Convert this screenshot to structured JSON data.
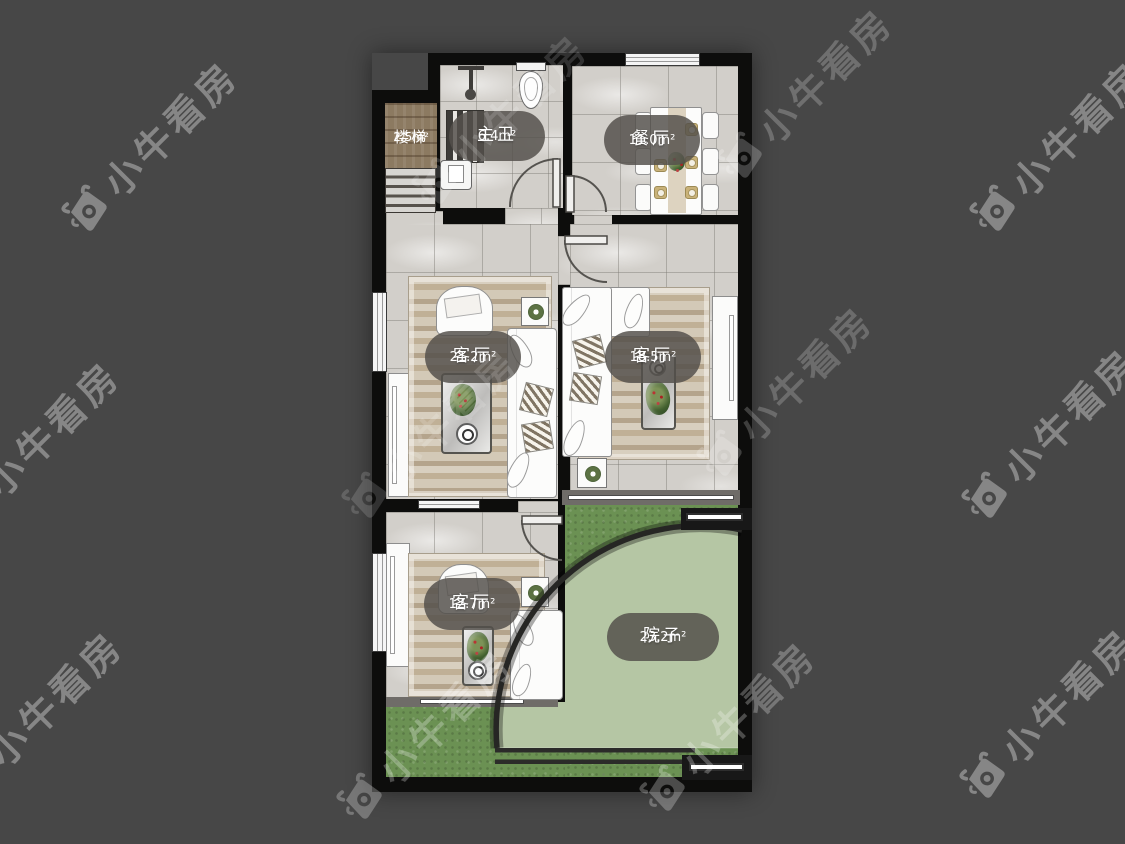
{
  "watermark": {
    "text": "小牛看房",
    "icon": "bull-camera-logo"
  },
  "rooms": {
    "stairs": {
      "name": "楼梯",
      "area": "2.5m²"
    },
    "bathroom": {
      "name": "主卫",
      "area": "6.4m²"
    },
    "dining": {
      "name": "餐厅",
      "area": "11.0m²"
    },
    "living_left": {
      "name": "客厅",
      "area": "21.2m²"
    },
    "living_right": {
      "name": "客厅",
      "area": "18.5m²"
    },
    "living_bottom": {
      "name": "客厅",
      "area": "12.7m²"
    },
    "yard": {
      "name": "院子",
      "area": "23.2m²"
    }
  },
  "colors": {
    "background": "#474747",
    "walls": "#0d0d0c",
    "tile_floor": "#d2cfca",
    "wood": "#8c7a61",
    "rug": "#cdc2ad",
    "grass_outer": "#6b9153",
    "grass_inner": "#b5c6a4",
    "label_capsule": "rgba(84,80,75,0.84)",
    "watermark_text": "#ffffff"
  }
}
